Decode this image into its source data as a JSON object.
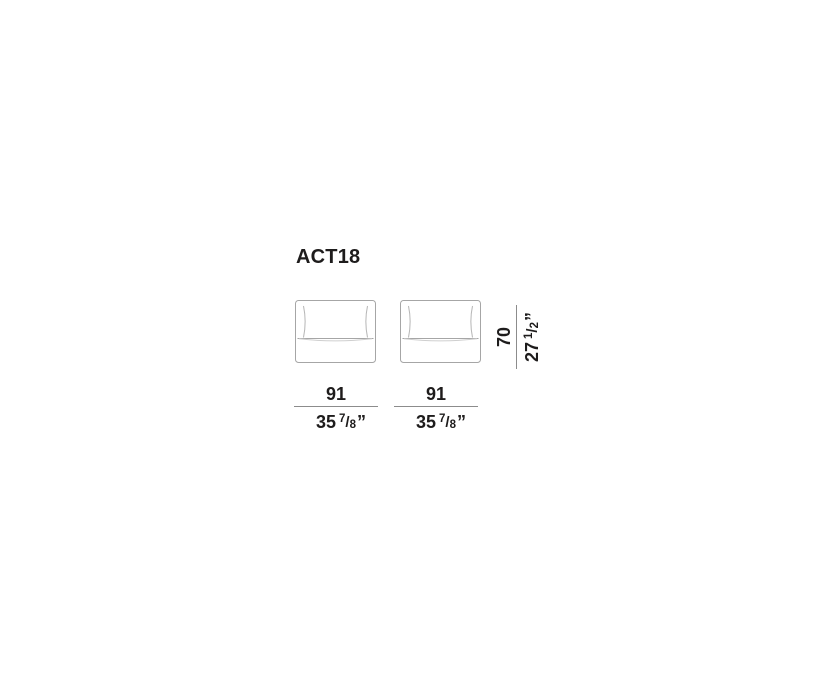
{
  "title": "ACT18",
  "colors": {
    "text": "#1e1c1c",
    "dim_line": "#8c8c8c",
    "sofa_outline": "#a6a6a6",
    "cushion_seam": "#b5b5b5",
    "seat_sag": "#cfcfcf",
    "background": "#ffffff"
  },
  "dimensions": {
    "width": {
      "cm": "91",
      "inch_whole": "35",
      "frac_num": "7",
      "frac_slash": "/",
      "frac_den": "8",
      "quote": "”"
    },
    "height": {
      "cm": "70",
      "inch_whole": "27",
      "frac_num": "1",
      "frac_slash": "/",
      "frac_den": "2",
      "quote": "”"
    }
  }
}
